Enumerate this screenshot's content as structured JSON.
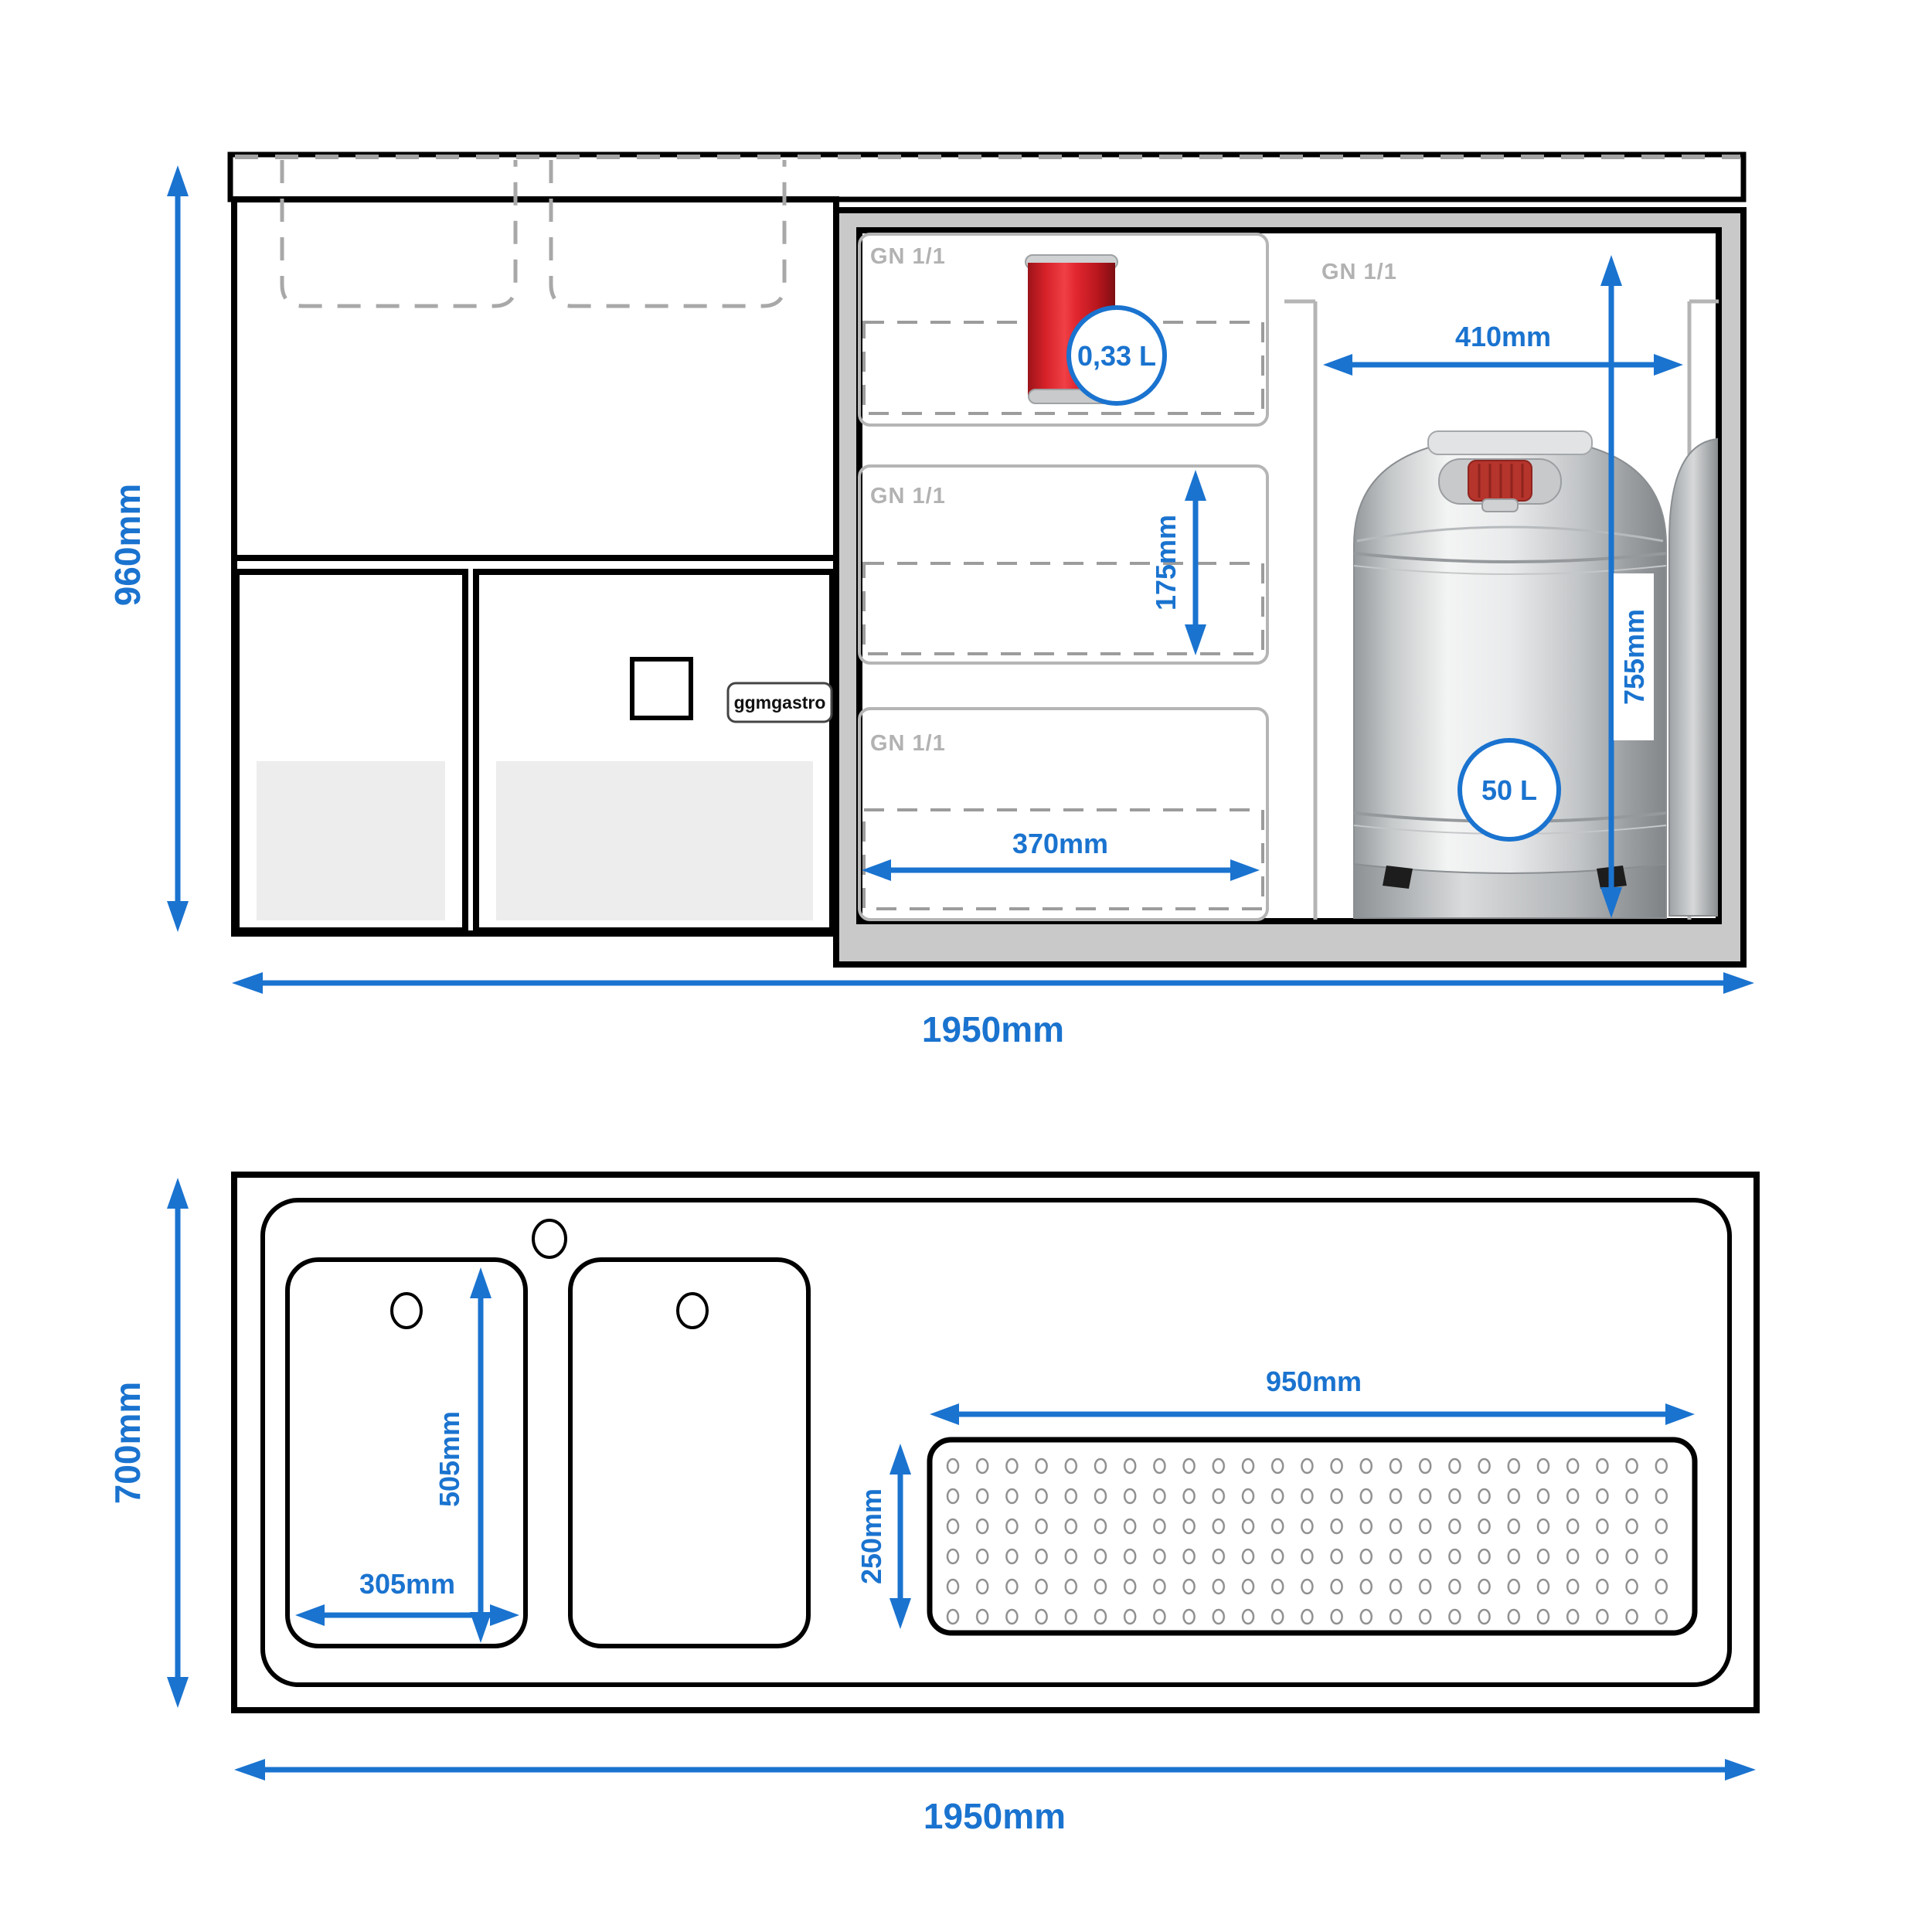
{
  "colors": {
    "accent": "#1a73cf",
    "line_black": "#000000",
    "fridge_frame_gray": "#c9c9c9",
    "label_gray": "#b2b2b2",
    "dash_gray": "#a3a3a3",
    "door_recess_gray": "#ededed"
  },
  "front_view": {
    "dimensions": {
      "overall_height": "960mm",
      "overall_width": "1950mm",
      "compartment_width": "410mm",
      "compartment_height": "755mm",
      "shelf_clearance": "175mm",
      "shelf_width": "370mm"
    },
    "labels": {
      "shelf_gn": "GN 1/1",
      "can_volume": "0,33 L",
      "keg_volume": "50 L",
      "brand": "ggmgastro"
    }
  },
  "top_view": {
    "dimensions": {
      "overall_depth": "700mm",
      "overall_width": "1950mm",
      "sink_width": "305mm",
      "sink_depth": "505mm",
      "drainer_width": "950mm",
      "drainer_depth": "250mm"
    }
  }
}
